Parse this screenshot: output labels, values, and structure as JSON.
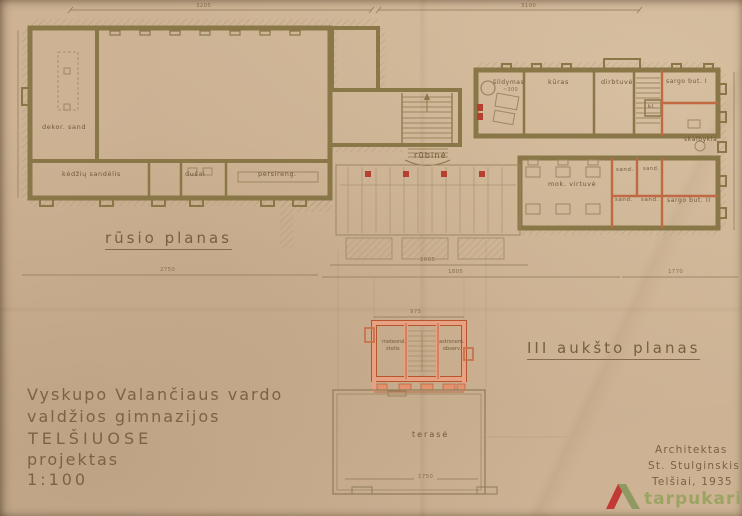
{
  "document": {
    "type": "architectural drawing, scanned 1935 blueprint",
    "scale_note": "1:100"
  },
  "palette": {
    "paper": "#cdb394",
    "wall_ink": "#897748",
    "thin_ink": "#9c8760",
    "text_ink": "#6e5939",
    "accent_orange_wall": "#e8a183",
    "accent_orange_edge": "#b5562f",
    "accent_red": "#b54030",
    "logo_red": "#c13a35",
    "logo_olive": "#8e9a62"
  },
  "titles": {
    "basement": "rūsio planas",
    "third_floor": "III aukšto planas"
  },
  "rooms_basement": {
    "dekor_sand": "dekor. sand",
    "kedziu_sandelis": "kėdžių sandėlis",
    "dusai": "dušai",
    "persireng": "persireng.",
    "sildymas": "šildymas",
    "sildymas_note": "~300",
    "rubine": "rūbinė",
    "kuras": "kūras",
    "dirbtuve": "dirbtuvė",
    "sargo_but_1": "sargo but. I",
    "kl": "kl.",
    "skalbykla": "skalbykla",
    "mok_virtuve": "mok. virtuvė",
    "sand_1": "sand.",
    "sand_2": "sand.",
    "sand_3": "sand.",
    "sand_4": "sand.",
    "sargo_but_2": "sargo but. II"
  },
  "rooms_third_floor": {
    "meteorol_line1": "meteorol.",
    "meteorol_line2": "stotis",
    "astronom_line1": "astronom.",
    "astronom_line2": "observ.",
    "terase": "terasė"
  },
  "dimensions": {
    "top_left": "3205",
    "top_right": "3100",
    "left_bottom": "2750",
    "bottom_1": "1605",
    "bottom_2": "1805",
    "bottom_3": "1770",
    "third_floor_top": "975",
    "terrace": "1750"
  },
  "title_block": {
    "line1": "Vyskupo Valančiaus vardo",
    "line2": "valdžios gimnazijos",
    "line3": "TELŠIUOSE",
    "line4": "projektas",
    "line5": "1:100"
  },
  "credit_block": {
    "line1": "Architektas",
    "line2": "St. Stulginskis",
    "line3": "Telšiai, 1935"
  },
  "watermark": {
    "label": "tarpukaris"
  }
}
